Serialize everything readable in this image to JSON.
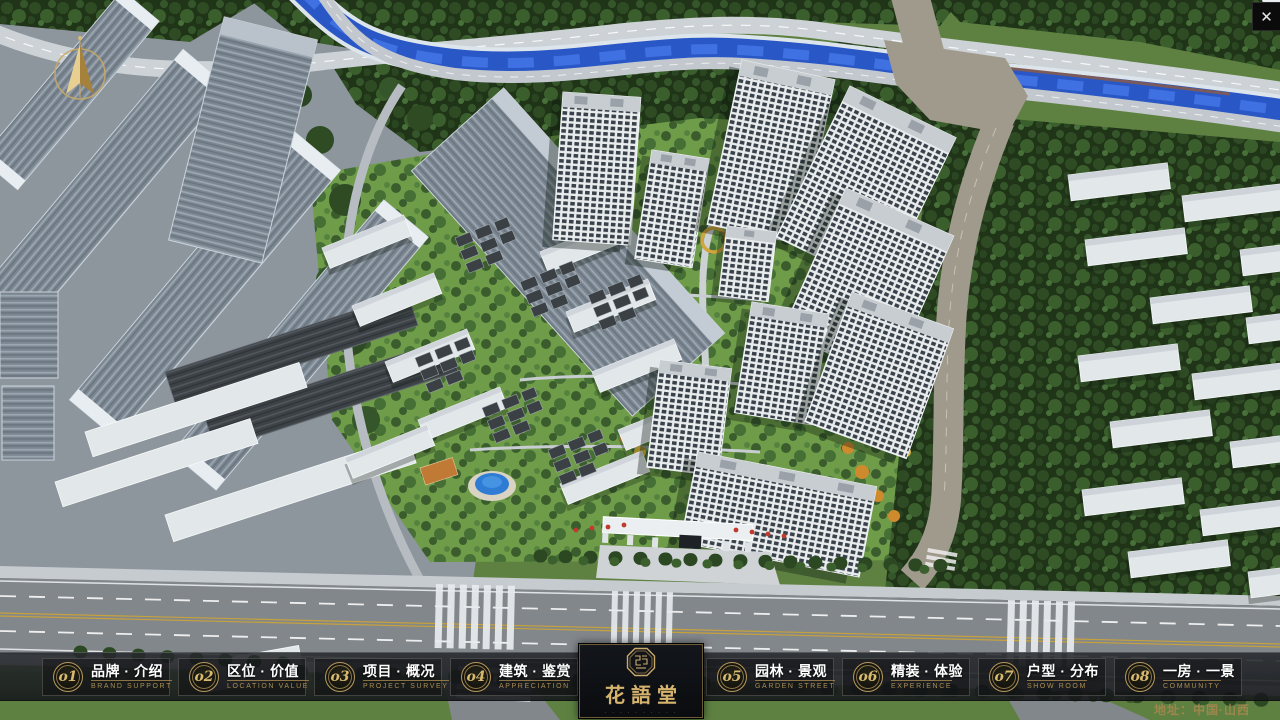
{
  "window": {
    "close_glyph": "✕"
  },
  "nav": {
    "items": [
      {
        "num": "o1",
        "zh": "品牌 · 介绍",
        "en": "BRAND SUPPORT"
      },
      {
        "num": "o2",
        "zh": "区位 · 价值",
        "en": "LOCATION VALUE"
      },
      {
        "num": "o3",
        "zh": "项目 · 概况",
        "en": "PROJECT SURVEY"
      },
      {
        "num": "o4",
        "zh": "建筑 · 鉴赏",
        "en": "APPRECIATION"
      },
      {
        "num": "o5",
        "zh": "园林 · 景观",
        "en": "GARDEN STREET"
      },
      {
        "num": "o6",
        "zh": "精装 · 体验",
        "en": "EXPERIENCE"
      },
      {
        "num": "o7",
        "zh": "户型 · 分布",
        "en": "SHOW ROOM"
      },
      {
        "num": "o8",
        "zh": "一房 · 一景",
        "en": "COMMUNITY"
      }
    ]
  },
  "logo": {
    "name": "花語堂",
    "tagline": "· · · · · · · · · ·"
  },
  "footer": {
    "address": "地址：中国·山西"
  },
  "colors": {
    "gold": "#c9ab6b",
    "bar_bg": "#1a1c20",
    "river": "#2a57c6",
    "accent_red": "#c03a2e"
  }
}
